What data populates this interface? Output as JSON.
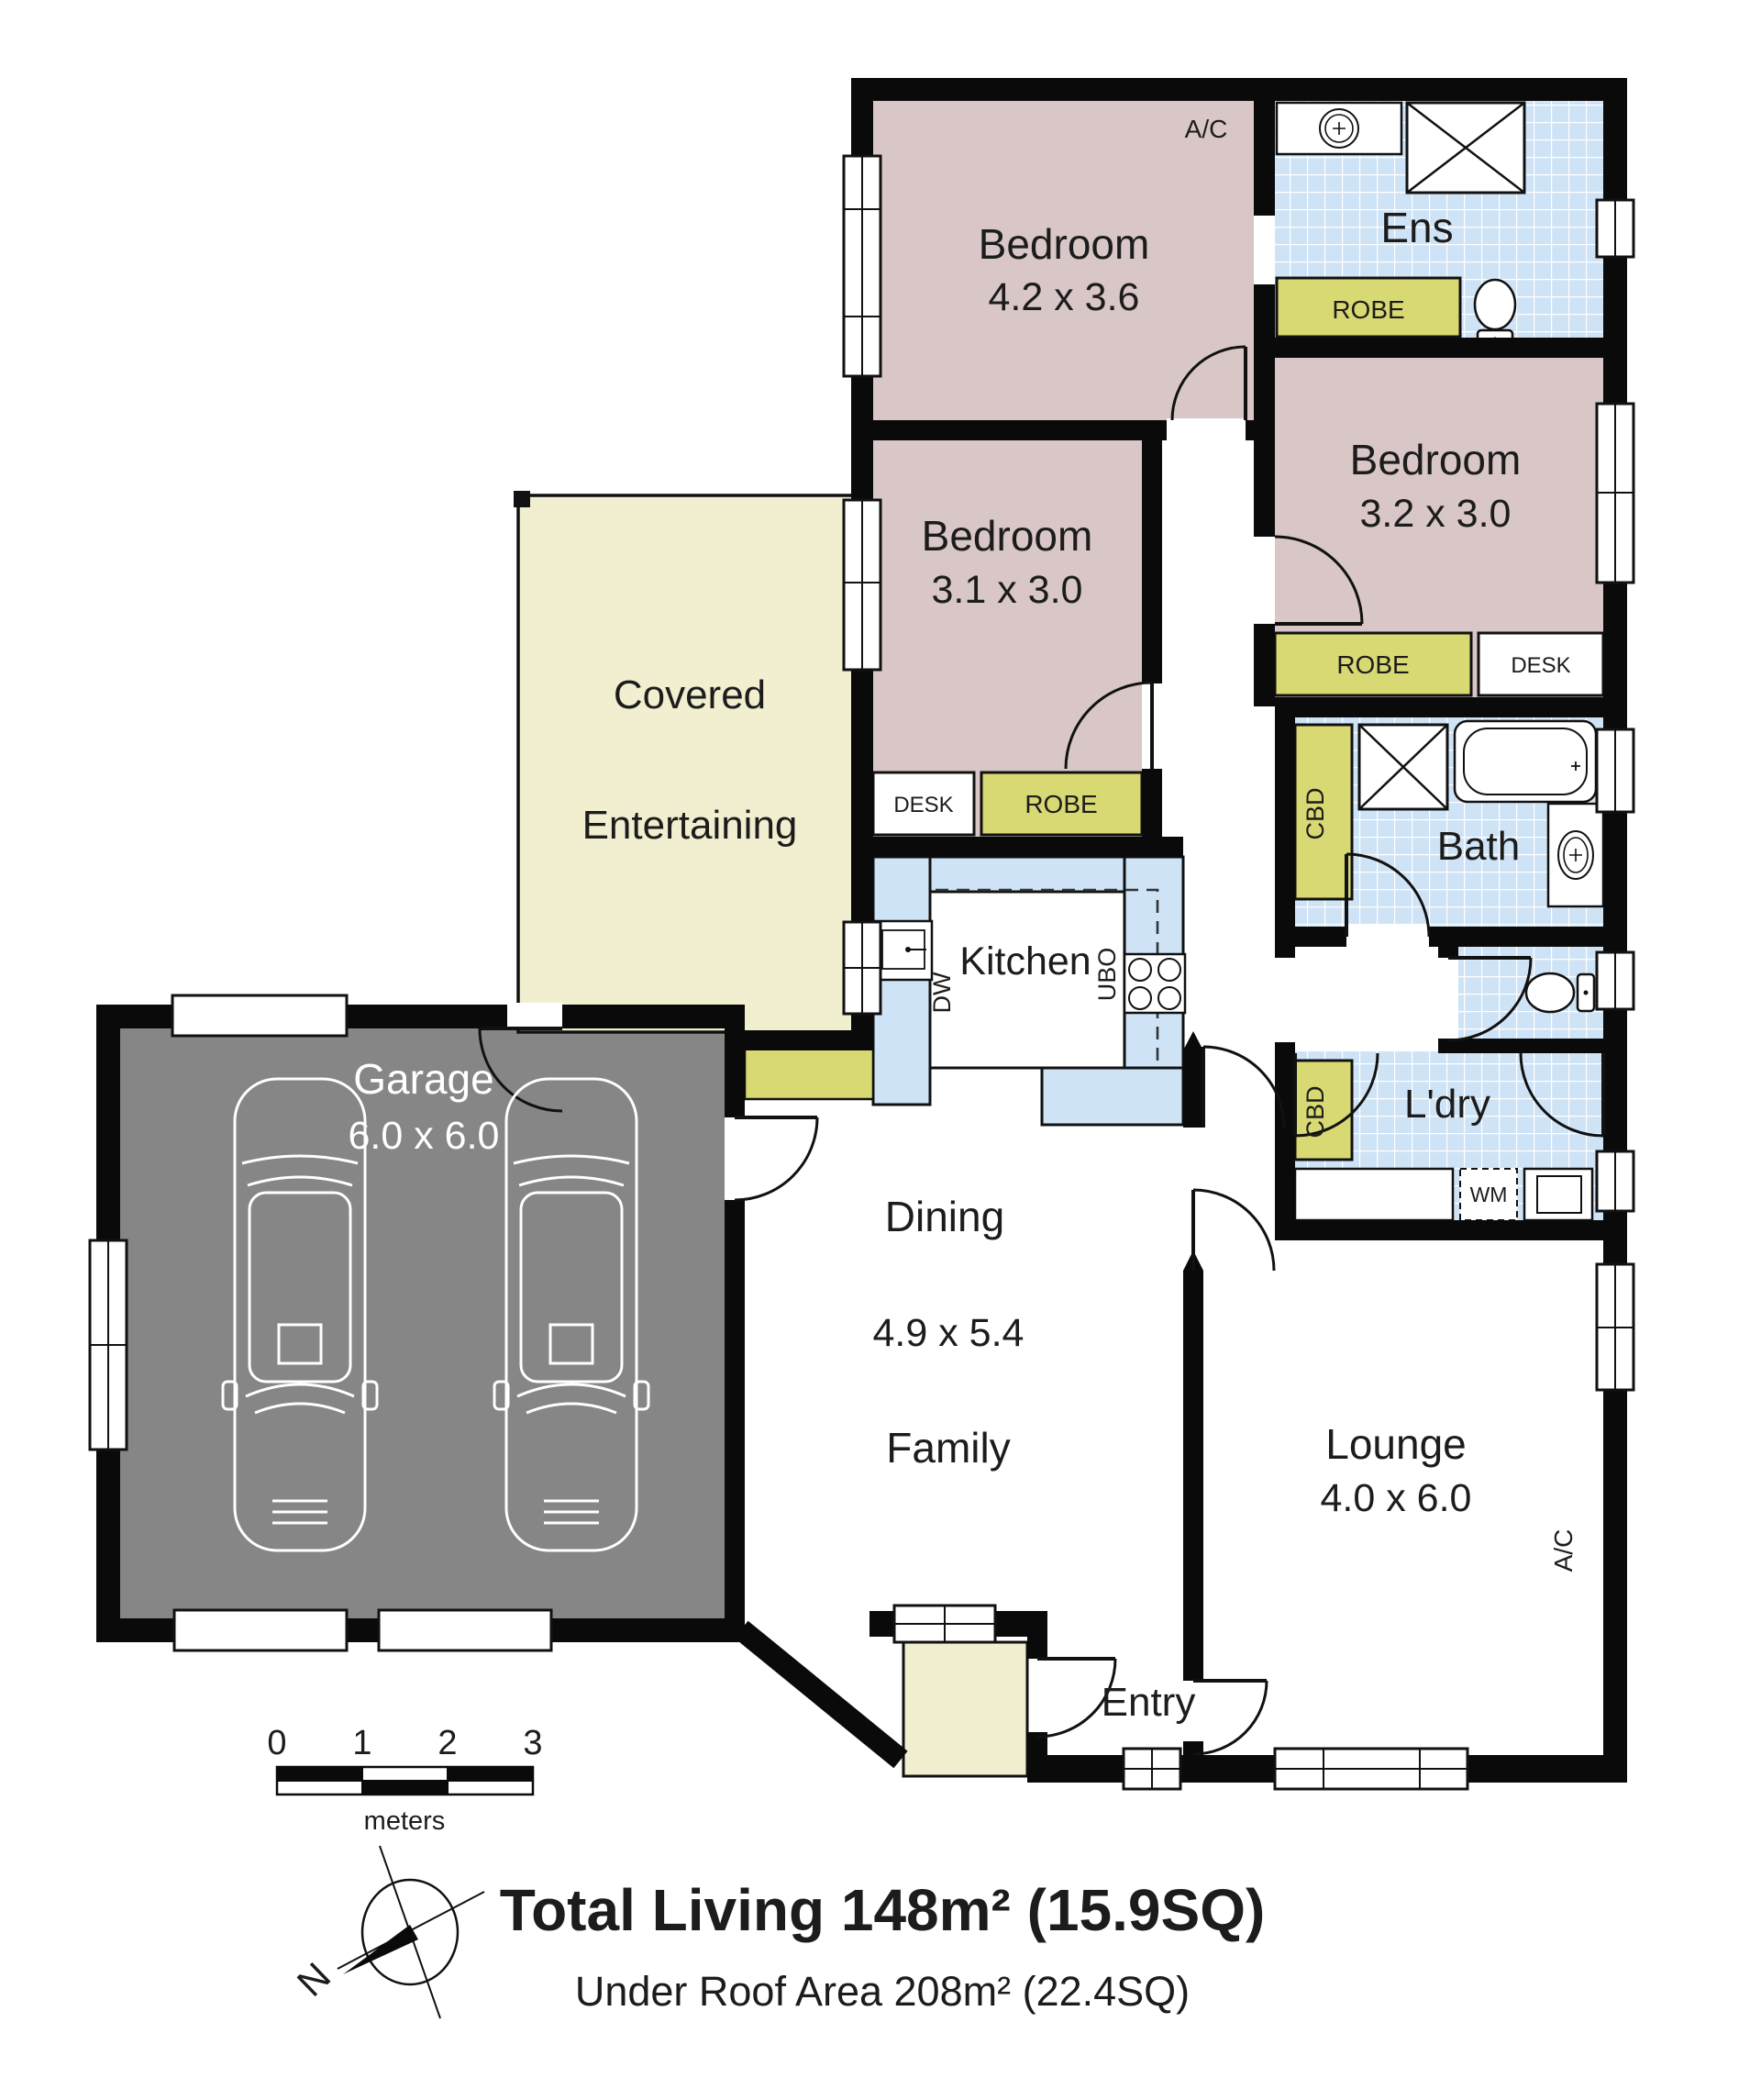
{
  "plan": {
    "rooms": {
      "bedroom1": {
        "name": "Bedroom",
        "dims": "4.2 x 3.6"
      },
      "bedroom2": {
        "name": "Bedroom",
        "dims": "3.2 x 3.0"
      },
      "bedroom3": {
        "name": "Bedroom",
        "dims": "3.1 x 3.0"
      },
      "ensuite": {
        "name": "Ens"
      },
      "bath": {
        "name": "Bath"
      },
      "laundry": {
        "name": "L'dry"
      },
      "kitchen": {
        "name": "Kitchen"
      },
      "dining": {
        "name": "Dining",
        "dims": "4.9 x 5.4"
      },
      "family": {
        "name": "Family"
      },
      "lounge": {
        "name": "Lounge",
        "dims": "4.0 x 6.0"
      },
      "entry": {
        "name": "Entry"
      },
      "garage": {
        "name": "Garage",
        "dims": "6.0 x 6.0"
      },
      "covered_entertaining": {
        "line1": "Covered",
        "line2": "Entertaining"
      }
    },
    "fixtures": {
      "robe": "ROBE",
      "desk": "DESK",
      "cbd": "CBD",
      "wm": "WM",
      "dw": "DW",
      "ubo": "UBO",
      "ac": "A/C"
    },
    "scale_bar": {
      "ticks": [
        "0",
        "1",
        "2",
        "3"
      ],
      "unit": "meters"
    },
    "compass": {
      "north": "N"
    },
    "summary": {
      "total_living": "Total Living 148m² (15.9SQ)",
      "under_roof": "Under Roof Area 208m² (22.4SQ)"
    },
    "colors": {
      "bedroom_pink": "#d9c6c6",
      "tile_blue": "#cfe3f6",
      "joinery_yellow": "#d9d973",
      "outdoor_cream": "#f1efcf",
      "garage_grey": "#868686",
      "wall_black": "#0a0a0a"
    }
  }
}
